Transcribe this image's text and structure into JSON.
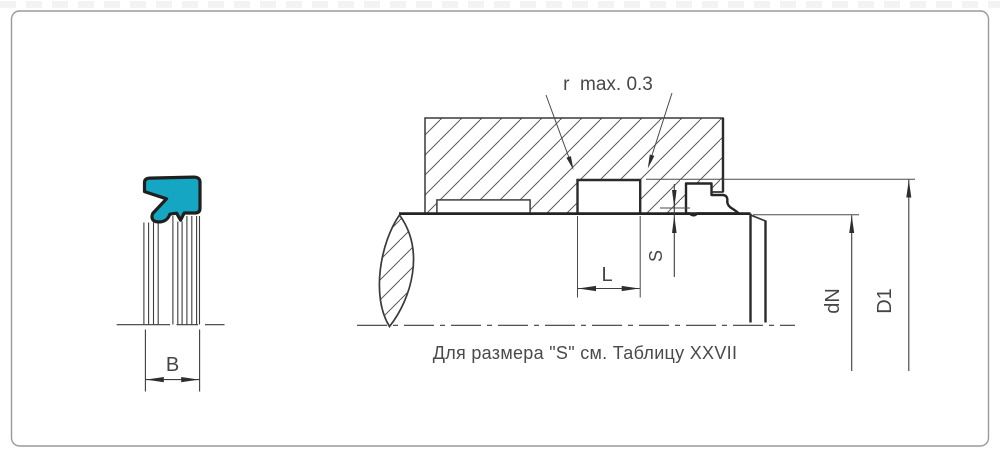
{
  "drawing": {
    "radius_note": "r  max. 0.3",
    "caption": "Для размера \"S\" см. Таблицу XXVII",
    "labels": {
      "seal_width": "B",
      "groove_length": "L",
      "clearance": "S",
      "shaft_diameter": "dN",
      "groove_diameter": "D1"
    }
  },
  "colors": {
    "seal_fill": "#14a6c2",
    "line": "#3d3d3d",
    "text": "#454545",
    "border": "#9a9a9a"
  }
}
